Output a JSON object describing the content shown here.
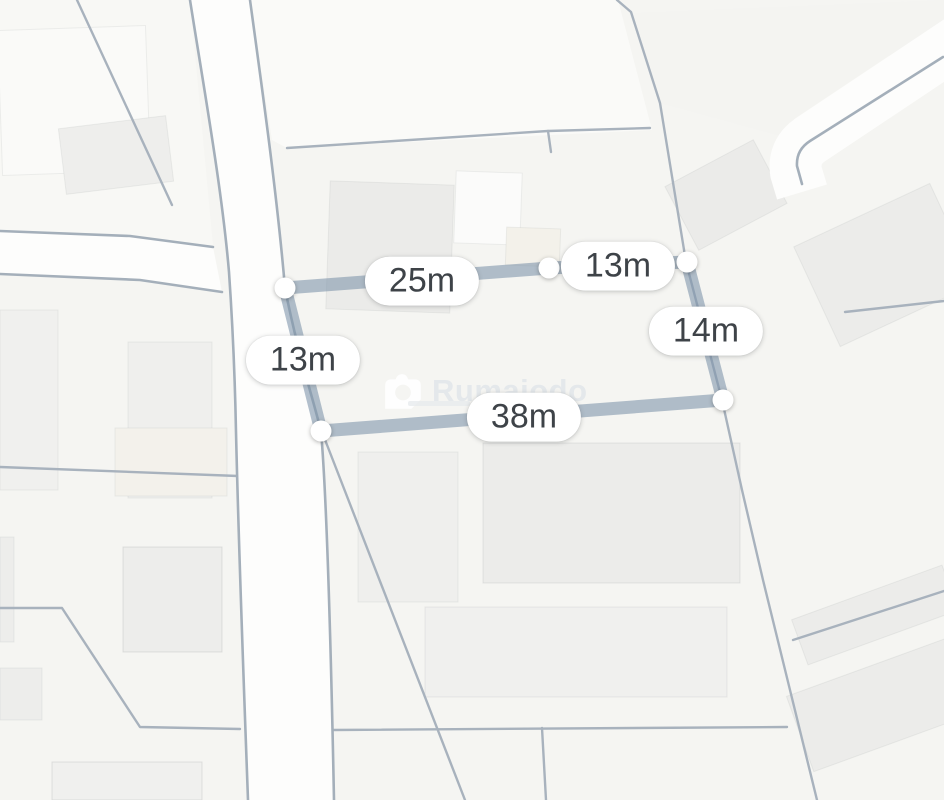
{
  "app": {
    "view": "map-measurement-view"
  },
  "watermark": {
    "brand": "Rumaiodo"
  },
  "measurements": {
    "unit": "m",
    "segments": [
      {
        "side": "top-left",
        "length_m": 25,
        "label": "25m"
      },
      {
        "side": "top-right",
        "length_m": 13,
        "label": "13m"
      },
      {
        "side": "right",
        "length_m": 14,
        "label": "14m"
      },
      {
        "side": "bottom",
        "length_m": 38,
        "label": "38m"
      },
      {
        "side": "left",
        "length_m": 13,
        "label": "13m"
      }
    ]
  },
  "colors": {
    "background": "#f5f5f2",
    "road_fill": "#fdfdfc",
    "parcel_line": "#a8b2bd",
    "building_fill": "#ededea",
    "measure_line": "#8096ab",
    "node_fill": "#ffffff",
    "label_text": "#3e4348",
    "watermark_text": "#e4e8eb"
  }
}
